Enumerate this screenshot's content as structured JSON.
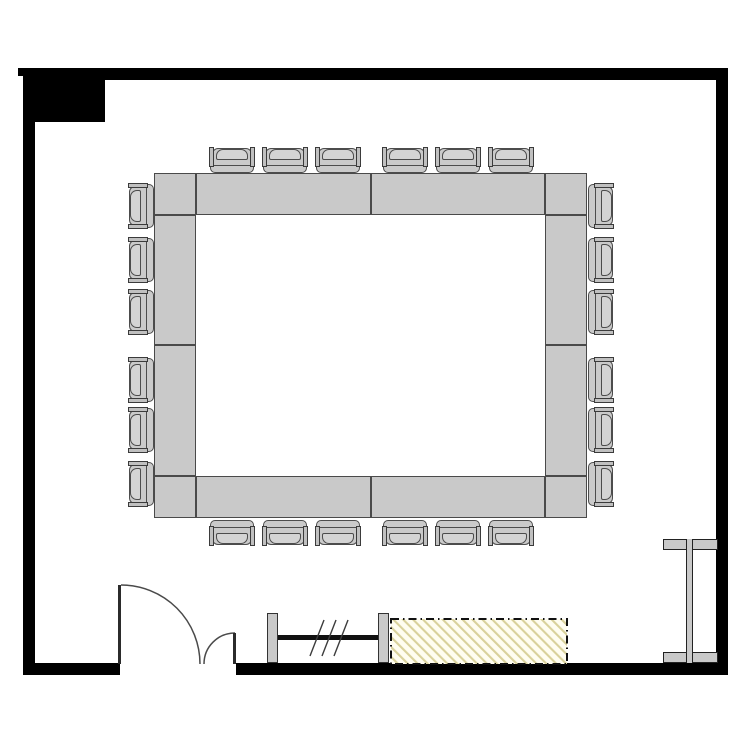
{
  "canvas": {
    "width": 750,
    "height": 750,
    "background": "#ffffff"
  },
  "colors": {
    "wall": "#000000",
    "furniture_fill": "#c9c9c9",
    "furniture_fill_light": "#d4d4d4",
    "furniture_stroke": "#4a4a4a",
    "door_line": "#4a4a4a",
    "door_leaf": "#2b2b2b",
    "counter_bg": "#fffdf0",
    "counter_hatch_line": "#d9d19b",
    "counter_border": "#111111",
    "rail_bar": "#111111"
  },
  "walls": [
    {
      "name": "wall-top",
      "x": 23,
      "y": 68,
      "w": 705,
      "h": 12
    },
    {
      "name": "wall-left",
      "x": 23,
      "y": 68,
      "w": 12,
      "h": 607
    },
    {
      "name": "wall-right",
      "x": 716,
      "y": 68,
      "w": 12,
      "h": 607
    },
    {
      "name": "wall-bottom-left",
      "x": 23,
      "y": 663,
      "w": 97,
      "h": 12
    },
    {
      "name": "wall-bottom-right",
      "x": 236,
      "y": 663,
      "w": 492,
      "h": 12
    },
    {
      "name": "wall-pilaster-top-left",
      "x": 23,
      "y": 68,
      "w": 82,
      "h": 54
    },
    {
      "name": "wall-corner-nub",
      "x": 18,
      "y": 68,
      "w": 5,
      "h": 8
    }
  ],
  "table": {
    "segments": [
      {
        "x": 154,
        "y": 173,
        "w": 42,
        "h": 42
      },
      {
        "x": 545,
        "y": 173,
        "w": 42,
        "h": 42
      },
      {
        "x": 154,
        "y": 476,
        "w": 42,
        "h": 42
      },
      {
        "x": 545,
        "y": 476,
        "w": 42,
        "h": 42
      },
      {
        "x": 196,
        "y": 173,
        "w": 175,
        "h": 42
      },
      {
        "x": 371,
        "y": 173,
        "w": 174,
        "h": 42
      },
      {
        "x": 196,
        "y": 476,
        "w": 175,
        "h": 42
      },
      {
        "x": 371,
        "y": 476,
        "w": 174,
        "h": 42
      },
      {
        "x": 154,
        "y": 215,
        "w": 42,
        "h": 130
      },
      {
        "x": 154,
        "y": 345,
        "w": 42,
        "h": 131
      },
      {
        "x": 545,
        "y": 215,
        "w": 42,
        "h": 130
      },
      {
        "x": 545,
        "y": 345,
        "w": 42,
        "h": 131
      }
    ]
  },
  "chairs": [
    {
      "cx": 232,
      "cy": 160,
      "rot": 0
    },
    {
      "cx": 285,
      "cy": 160,
      "rot": 0
    },
    {
      "cx": 338,
      "cy": 160,
      "rot": 0
    },
    {
      "cx": 405,
      "cy": 160,
      "rot": 0
    },
    {
      "cx": 458,
      "cy": 160,
      "rot": 0
    },
    {
      "cx": 511,
      "cy": 160,
      "rot": 0
    },
    {
      "cx": 232,
      "cy": 533,
      "rot": 180
    },
    {
      "cx": 285,
      "cy": 533,
      "rot": 180
    },
    {
      "cx": 338,
      "cy": 533,
      "rot": 180
    },
    {
      "cx": 405,
      "cy": 533,
      "rot": 180
    },
    {
      "cx": 458,
      "cy": 533,
      "rot": 180
    },
    {
      "cx": 511,
      "cy": 533,
      "rot": 180
    },
    {
      "cx": 141,
      "cy": 206,
      "rot": -90
    },
    {
      "cx": 141,
      "cy": 260,
      "rot": -90
    },
    {
      "cx": 141,
      "cy": 312,
      "rot": -90
    },
    {
      "cx": 141,
      "cy": 380,
      "rot": -90
    },
    {
      "cx": 141,
      "cy": 430,
      "rot": -90
    },
    {
      "cx": 141,
      "cy": 484,
      "rot": -90
    },
    {
      "cx": 601,
      "cy": 206,
      "rot": 90
    },
    {
      "cx": 601,
      "cy": 260,
      "rot": 90
    },
    {
      "cx": 601,
      "cy": 312,
      "rot": 90
    },
    {
      "cx": 601,
      "cy": 380,
      "rot": 90
    },
    {
      "cx": 601,
      "cy": 430,
      "rot": 90
    },
    {
      "cx": 601,
      "cy": 484,
      "rot": 90
    }
  ],
  "door": {
    "leaves": [
      {
        "x": 118,
        "y": 585,
        "w": 3,
        "h": 79
      },
      {
        "x": 233,
        "y": 633,
        "w": 3,
        "h": 31
      }
    ],
    "arcs": [
      "M 121 585 A 79 79 0 0 1 200 664",
      "M 235 633 A 31 31 0 0 0 204 664"
    ]
  },
  "coat_rail": {
    "posts": [
      {
        "x": 267,
        "y": 613,
        "w": 11,
        "h": 50
      },
      {
        "x": 378,
        "y": 613,
        "w": 11,
        "h": 50
      }
    ],
    "bar": {
      "x": 278,
      "y": 635,
      "w": 100,
      "h": 5
    },
    "slashes": [
      [
        310,
        656,
        324,
        620
      ],
      [
        322,
        656,
        336,
        620
      ],
      [
        334,
        656,
        348,
        620
      ]
    ]
  },
  "counter": {
    "x": 391,
    "y": 619,
    "w": 176,
    "h": 45
  },
  "column": {
    "flanges": [
      {
        "x": 663,
        "y": 539,
        "w": 55,
        "h": 11
      },
      {
        "x": 663,
        "y": 652,
        "w": 55,
        "h": 11
      }
    ],
    "web": {
      "x": 686,
      "y": 539,
      "w": 7,
      "h": 124
    }
  }
}
